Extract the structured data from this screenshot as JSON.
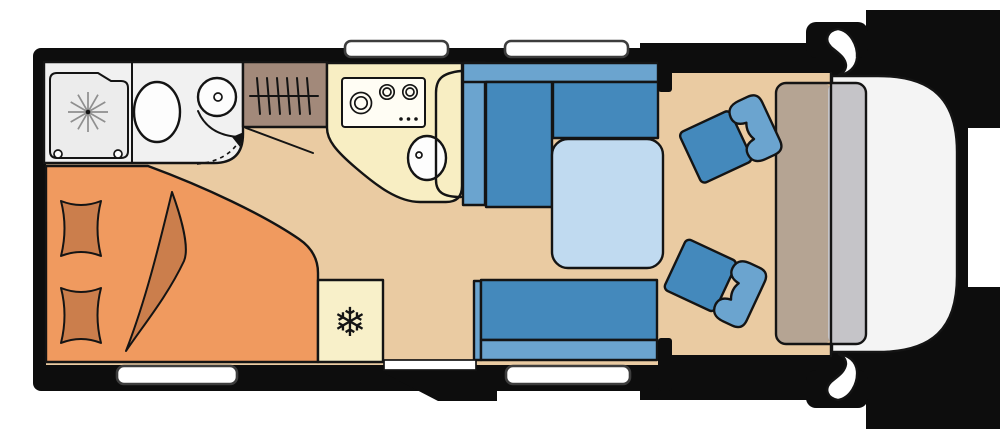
{
  "colors": {
    "body": "#0d0d0d",
    "floor": "#eacba2",
    "bathroom": "#f1f1f1",
    "tray": "#ececec",
    "fixture": "#fdfdfd",
    "wardrobe": "#a2897a",
    "kitchen": "#f8eec3",
    "fridge": "#f8f0c9",
    "stove": "#fffdf4",
    "bed": "#f09a5f",
    "bedding": "#cb7e4c",
    "seat": "#4489bc",
    "seat_light": "#6ba4cf",
    "table": "#c0daf0",
    "dash_left": "#b5a493",
    "dash_right": "#c5c4c8",
    "nose": "#f4f4f4",
    "window": "#ffffff",
    "notch": "#ffffff",
    "ink": "#141414"
  },
  "glyphs": {
    "snowflake": "❄"
  }
}
